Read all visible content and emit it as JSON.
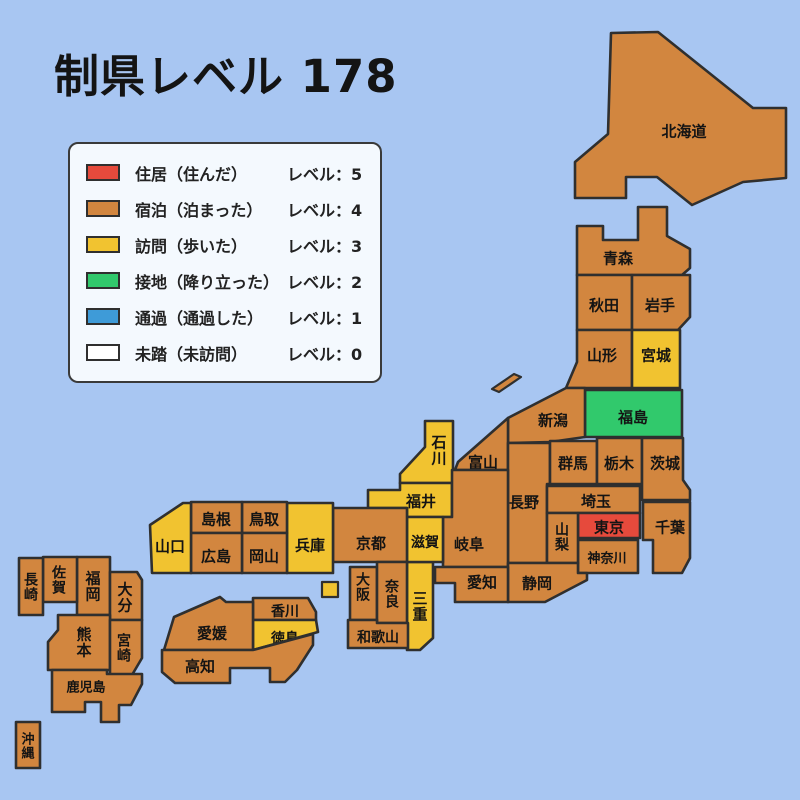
{
  "title": "制県レベル 178",
  "legend": {
    "items": [
      {
        "id": "lv5",
        "label": "住居（住んだ）",
        "level_text": "レベル：5",
        "color": "#e64a3c"
      },
      {
        "id": "lv4",
        "label": "宿泊（泊まった）",
        "level_text": "レベル：4",
        "color": "#d2863f"
      },
      {
        "id": "lv3",
        "label": "訪問（歩いた）",
        "level_text": "レベル：3",
        "color": "#f1c330"
      },
      {
        "id": "lv2",
        "label": "接地（降り立った）",
        "level_text": "レベル：2",
        "color": "#31c96c"
      },
      {
        "id": "lv1",
        "label": "通過（通過した）",
        "level_text": "レベル：1",
        "color": "#3e9bd8"
      },
      {
        "id": "lv0",
        "label": "未踏（未訪問）",
        "level_text": "レベル：0",
        "color": "#ffffff"
      }
    ]
  },
  "map": {
    "sea_color": "#a8c6f2",
    "border_color": "#2f2f2f",
    "label_color": "#141414",
    "level_colors": {
      "0": "#ffffff",
      "1": "#3e9bd8",
      "2": "#31c96c",
      "3": "#f1c330",
      "4": "#d2863f",
      "5": "#e64a3c"
    },
    "prefectures": [
      {
        "id": "hokkaido",
        "label": "北海道",
        "level": 4
      },
      {
        "id": "aomori",
        "label": "青森",
        "level": 4
      },
      {
        "id": "akita",
        "label": "秋田",
        "level": 4
      },
      {
        "id": "iwate",
        "label": "岩手",
        "level": 4
      },
      {
        "id": "yamagata",
        "label": "山形",
        "level": 4
      },
      {
        "id": "miyagi",
        "label": "宮城",
        "level": 3
      },
      {
        "id": "fukushima",
        "label": "福島",
        "level": 2
      },
      {
        "id": "niigata",
        "label": "新潟",
        "level": 4
      },
      {
        "id": "toyama",
        "label": "富山",
        "level": 4
      },
      {
        "id": "ishikawa",
        "label": "石川",
        "level": 3
      },
      {
        "id": "fukui",
        "label": "福井",
        "level": 3
      },
      {
        "id": "nagano",
        "label": "長野",
        "level": 4
      },
      {
        "id": "gifu",
        "label": "岐阜",
        "level": 4
      },
      {
        "id": "gunma",
        "label": "群馬",
        "level": 4
      },
      {
        "id": "tochigi",
        "label": "栃木",
        "level": 4
      },
      {
        "id": "ibaraki",
        "label": "茨城",
        "level": 4
      },
      {
        "id": "saitama",
        "label": "埼玉",
        "level": 4
      },
      {
        "id": "tokyo",
        "label": "東京",
        "level": 5
      },
      {
        "id": "chiba",
        "label": "千葉",
        "level": 4
      },
      {
        "id": "kanagawa",
        "label": "神奈川",
        "level": 4
      },
      {
        "id": "yamanashi",
        "label": "山梨",
        "level": 4
      },
      {
        "id": "shizuoka",
        "label": "静岡",
        "level": 4
      },
      {
        "id": "aichi",
        "label": "愛知",
        "level": 4
      },
      {
        "id": "mie",
        "label": "三重",
        "level": 3
      },
      {
        "id": "shiga",
        "label": "滋賀",
        "level": 3
      },
      {
        "id": "kyoto",
        "label": "京都",
        "level": 4
      },
      {
        "id": "osaka",
        "label": "大阪",
        "level": 4
      },
      {
        "id": "nara",
        "label": "奈良",
        "level": 4
      },
      {
        "id": "wakayama",
        "label": "和歌山",
        "level": 4
      },
      {
        "id": "hyogo",
        "label": "兵庫",
        "level": 3
      },
      {
        "id": "tottori",
        "label": "鳥取",
        "level": 4
      },
      {
        "id": "shimane",
        "label": "島根",
        "level": 4
      },
      {
        "id": "okayama",
        "label": "岡山",
        "level": 4
      },
      {
        "id": "hiroshima",
        "label": "広島",
        "level": 4
      },
      {
        "id": "yamaguchi",
        "label": "山口",
        "level": 3
      },
      {
        "id": "kagawa",
        "label": "香川",
        "level": 4
      },
      {
        "id": "tokushima",
        "label": "徳島",
        "level": 3
      },
      {
        "id": "ehime",
        "label": "愛媛",
        "level": 4
      },
      {
        "id": "kochi",
        "label": "高知",
        "level": 4
      },
      {
        "id": "fukuoka",
        "label": "福岡",
        "level": 4
      },
      {
        "id": "saga",
        "label": "佐賀",
        "level": 4
      },
      {
        "id": "nagasaki",
        "label": "長崎",
        "level": 4
      },
      {
        "id": "oita",
        "label": "大分",
        "level": 4
      },
      {
        "id": "kumamoto",
        "label": "熊本",
        "level": 4
      },
      {
        "id": "miyazaki",
        "label": "宮崎",
        "level": 4
      },
      {
        "id": "kagoshima",
        "label": "鹿児島",
        "level": 4
      },
      {
        "id": "okinawa",
        "label": "沖縄",
        "level": 4
      }
    ],
    "islands": [
      {
        "id": "sado",
        "level": 4
      },
      {
        "id": "awaji",
        "level": 3
      }
    ]
  }
}
